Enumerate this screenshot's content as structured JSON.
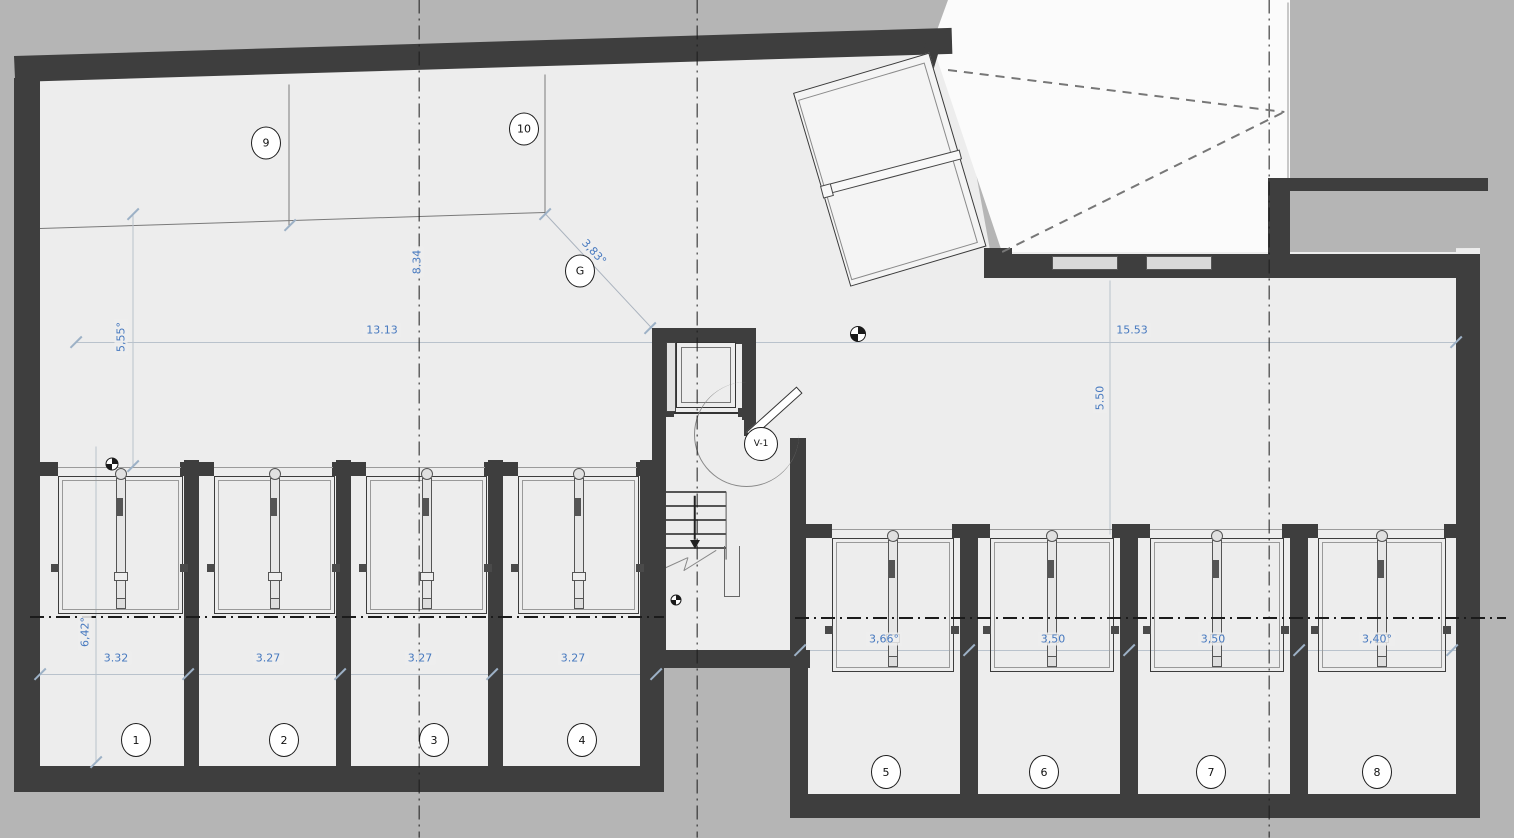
{
  "title": "basement-garage-floor-plan",
  "colors": {
    "background": "#b5b5b5",
    "floor": "#ededed",
    "wall": "#3e3e3e",
    "ramp_white": "#fbfbfb",
    "dim_blue": "#4779bf",
    "centerline": "#1b1b1b",
    "thin_line": "#7a7a7a",
    "dim_line": "#b9c2cc",
    "tick": "#9db1c6"
  },
  "watermark": {
    "part1": "DRAFT",
    "part2": "IИ",
    "part3": "HOMES"
  },
  "level_marker": {
    "value": "121,60"
  },
  "elevator": {
    "label": "Elevador"
  },
  "stairs": {
    "numbers_bottom_to_top": "-8 -9 -10 -11 -12 -13 -14 -15 -16"
  },
  "bubbles": [
    {
      "t": "9",
      "x": 266,
      "y": 143,
      "w": 28,
      "h": 31
    },
    {
      "t": "10",
      "x": 524,
      "y": 129,
      "w": 28,
      "h": 31
    },
    {
      "t": "G",
      "x": 580,
      "y": 271,
      "w": 28,
      "h": 31
    },
    {
      "t": "V-1",
      "x": 761,
      "y": 444,
      "w": 32,
      "h": 32,
      "fs": 9
    },
    {
      "t": "1",
      "x": 136,
      "y": 740,
      "w": 28,
      "h": 32
    },
    {
      "t": "2",
      "x": 284,
      "y": 740,
      "w": 28,
      "h": 32
    },
    {
      "t": "3",
      "x": 434,
      "y": 740,
      "w": 28,
      "h": 32
    },
    {
      "t": "4",
      "x": 582,
      "y": 740,
      "w": 28,
      "h": 32
    },
    {
      "t": "5",
      "x": 886,
      "y": 772,
      "w": 28,
      "h": 32
    },
    {
      "t": "6",
      "x": 1044,
      "y": 772,
      "w": 28,
      "h": 32
    },
    {
      "t": "7",
      "x": 1211,
      "y": 772,
      "w": 28,
      "h": 32
    },
    {
      "t": "8",
      "x": 1377,
      "y": 772,
      "w": 28,
      "h": 32
    }
  ],
  "dim_labels": [
    {
      "t": "13.13",
      "x": 382,
      "y": 330,
      "r": 0
    },
    {
      "t": "15.53",
      "x": 1132,
      "y": 330,
      "r": 0
    },
    {
      "t": "5,55°",
      "x": 121,
      "y": 337,
      "r": -90
    },
    {
      "t": "8.34",
      "x": 417,
      "y": 262,
      "r": -90
    },
    {
      "t": "5.50",
      "x": 1100,
      "y": 398,
      "r": -90
    },
    {
      "t": "6,42°",
      "x": 85,
      "y": 632,
      "r": -90
    },
    {
      "t": "3.32",
      "x": 116,
      "y": 658,
      "r": 0
    },
    {
      "t": "3.27",
      "x": 268,
      "y": 658,
      "r": 0
    },
    {
      "t": "3.27",
      "x": 420,
      "y": 658,
      "r": 0
    },
    {
      "t": "3.27",
      "x": 573,
      "y": 658,
      "r": 0
    },
    {
      "t": "3,66°",
      "x": 884,
      "y": 639,
      "r": 0
    },
    {
      "t": "3,50",
      "x": 1053,
      "y": 639,
      "r": 0
    },
    {
      "t": "3,50",
      "x": 1213,
      "y": 639,
      "r": 0
    },
    {
      "t": "3,40°",
      "x": 1377,
      "y": 639,
      "r": 0
    },
    {
      "t": "3,83°",
      "x": 594,
      "y": 252,
      "r": 47
    }
  ],
  "geometry": {
    "floors": [
      {
        "name": "floor-interior",
        "color": "#ededed",
        "points": "14,58 950,30 990,250 1480,248 1480,818 792,818 792,664 650,664 650,792 14,792"
      },
      {
        "name": "ramp-driveway",
        "color": "#fbfbfb",
        "points": "932,44 948,0 1290,0 1290,252 1002,252"
      },
      {
        "name": "outside-pocket",
        "color": "#b5b5b5",
        "points": "1290,190 1456,190 1456,252 1290,252"
      }
    ],
    "walls": [
      [
        14,
        56,
        938,
        26,
        -1.72
      ],
      [
        14,
        78,
        26,
        714,
        0
      ],
      [
        14,
        766,
        650,
        26,
        0
      ],
      [
        640,
        460,
        24,
        306,
        0
      ],
      [
        184,
        460,
        15,
        306,
        0
      ],
      [
        336,
        460,
        15,
        306,
        0
      ],
      [
        488,
        460,
        15,
        306,
        0
      ],
      [
        40,
        462,
        18,
        14,
        0
      ],
      [
        180,
        462,
        34,
        14,
        0
      ],
      [
        332,
        462,
        34,
        14,
        0
      ],
      [
        484,
        462,
        34,
        14,
        0
      ],
      [
        636,
        462,
        28,
        14,
        0
      ],
      [
        652,
        328,
        104,
        16,
        0
      ],
      [
        652,
        328,
        14,
        92,
        0
      ],
      [
        742,
        328,
        14,
        92,
        0
      ],
      [
        652,
        420,
        14,
        248,
        0
      ],
      [
        652,
        650,
        158,
        18,
        0
      ],
      [
        790,
        438,
        16,
        212,
        0
      ],
      [
        744,
        408,
        12,
        28,
        0
      ],
      [
        790,
        650,
        18,
        168,
        0
      ],
      [
        790,
        794,
        690,
        24,
        0
      ],
      [
        1456,
        260,
        24,
        558,
        0
      ],
      [
        988,
        254,
        492,
        24,
        0
      ],
      [
        1268,
        178,
        220,
        13,
        0
      ],
      [
        1268,
        183,
        22,
        76,
        0
      ],
      [
        926,
        42,
        15,
        216,
        16.5
      ],
      [
        984,
        248,
        28,
        30,
        0
      ],
      [
        960,
        524,
        18,
        270,
        0
      ],
      [
        1120,
        524,
        18,
        270,
        0
      ],
      [
        1290,
        524,
        18,
        270,
        0
      ],
      [
        790,
        524,
        42,
        14,
        0
      ],
      [
        952,
        524,
        38,
        14,
        0
      ],
      [
        1112,
        524,
        38,
        14,
        0
      ],
      [
        1282,
        524,
        36,
        14,
        0
      ],
      [
        1444,
        524,
        14,
        14,
        0
      ],
      [
        662,
        408,
        12,
        9,
        0
      ],
      [
        738,
        408,
        12,
        9,
        0
      ]
    ],
    "boxes": [
      {
        "n": "gate-leaf",
        "b": [
          793,
          93,
          140,
          200,
          -16.5
        ],
        "fill": "#f4f4f4",
        "bc": "#3a3a3a",
        "bw": 1.5
      },
      {
        "n": "gate-leaf-inner",
        "b": [
          798,
          100,
          130,
          186,
          -16.5
        ],
        "fill": "transparent",
        "bc": "#8a8a8a",
        "bw": 1
      },
      {
        "n": "gate-arm",
        "b": [
          828,
          184,
          134,
          8,
          -14.7
        ],
        "fill": "#f8f8f8",
        "bc": "#444",
        "bw": 1
      },
      {
        "n": "gate-arm-tip",
        "b": [
          820,
          186,
          9,
          11,
          -14.7
        ],
        "fill": "#f8f8f8",
        "bc": "#444",
        "bw": 1
      },
      {
        "n": "elevator-cab",
        "b": [
          676,
          342,
          58,
          64,
          0
        ],
        "fill": "#ededed",
        "bc": "#333",
        "bw": 1.5
      },
      {
        "n": "elevator-cab-inner",
        "b": [
          681,
          347,
          48,
          54,
          0
        ],
        "fill": "transparent",
        "bc": "#777",
        "bw": 1
      },
      {
        "n": "elevator-rail",
        "b": [
          666,
          342,
          8,
          68,
          0
        ],
        "fill": "#e0e0e0",
        "bc": "#444",
        "bw": 1
      },
      {
        "n": "wall-grille",
        "b": [
          1052,
          256,
          64,
          12,
          0
        ],
        "fill": "#d9d9d9",
        "bc": "#555",
        "bw": 1
      },
      {
        "n": "wall-grille",
        "b": [
          1146,
          256,
          64,
          12,
          0
        ],
        "fill": "#d9d9d9",
        "bc": "#555",
        "bw": 1
      },
      {
        "n": "door-v1-leaf",
        "b": [
          746,
          432,
          66,
          7,
          -42
        ],
        "fill": "#fff",
        "bc": "#333",
        "bw": 1.5
      },
      {
        "n": "door-v1-arc",
        "b": [
          694,
          382,
          104,
          104,
          0
        ],
        "fill": "transparent",
        "bc": "#888",
        "bw": 1.2,
        "radius": "50%",
        "sides": "lb"
      },
      {
        "n": "stair-handrail",
        "b": [
          724,
          546,
          14,
          50,
          0
        ],
        "fill": "transparent",
        "bc": "#666",
        "bw": 1.5,
        "sides": "lrb"
      }
    ],
    "lines": [
      [
        76,
        342,
        1458,
        342,
        1,
        "#b9c2cc"
      ],
      [
        40,
        228,
        545,
        212,
        1,
        "#7a7a7a"
      ],
      [
        289,
        84,
        289,
        226,
        1,
        "#7a7a7a"
      ],
      [
        545,
        74,
        545,
        213,
        1,
        "#7a7a7a"
      ],
      [
        545,
        213,
        654,
        330,
        1,
        "#aab3be"
      ],
      [
        1288,
        2,
        1288,
        184,
        1,
        "#949494"
      ],
      [
        133,
        214,
        133,
        466,
        1,
        "#b9c2cc"
      ],
      [
        96,
        446,
        96,
        762,
        1,
        "#b9c2cc"
      ],
      [
        1110,
        280,
        1110,
        534,
        1,
        "#b9c2cc"
      ],
      [
        40,
        674,
        658,
        674,
        1,
        "#b9c2cc"
      ],
      [
        800,
        650,
        1456,
        650,
        1,
        "#b9c2cc"
      ],
      [
        664,
        413,
        742,
        413,
        1.5,
        "#333"
      ],
      [
        666,
        492,
        726,
        492,
        1.2,
        "#555"
      ],
      [
        666,
        506,
        726,
        506,
        1.2,
        "#555"
      ],
      [
        666,
        520,
        726,
        520,
        1.2,
        "#555"
      ],
      [
        666,
        534,
        726,
        534,
        1.2,
        "#555"
      ],
      [
        666,
        548,
        726,
        548,
        1.2,
        "#555"
      ],
      [
        726,
        492,
        726,
        560,
        1.2,
        "#555"
      ],
      [
        695,
        496,
        695,
        540,
        1.5,
        "#222"
      ],
      [
        664,
        568,
        688,
        557,
        1,
        "#888"
      ],
      [
        688,
        557,
        684,
        570,
        1,
        "#888"
      ],
      [
        684,
        570,
        716,
        550,
        1,
        "#888"
      ]
    ],
    "dashdot": [
      [
        419,
        0,
        419,
        838
      ],
      [
        697,
        0,
        697,
        838
      ],
      [
        1269,
        0,
        1269,
        838
      ],
      [
        30,
        617,
        664,
        617
      ],
      [
        795,
        618,
        1506,
        618
      ]
    ],
    "dashed": [
      [
        948,
        70,
        1284,
        112
      ],
      [
        1002,
        252,
        1284,
        112
      ]
    ],
    "ticks": [
      [
        76,
        342
      ],
      [
        1456,
        342
      ],
      [
        133,
        214
      ],
      [
        133,
        466
      ],
      [
        96,
        762
      ],
      [
        40,
        674
      ],
      [
        188,
        674
      ],
      [
        340,
        674
      ],
      [
        492,
        674
      ],
      [
        656,
        674
      ],
      [
        800,
        650
      ],
      [
        969,
        650
      ],
      [
        1129,
        650
      ],
      [
        1299,
        650
      ],
      [
        1452,
        650
      ],
      [
        290,
        225
      ],
      [
        545,
        214
      ],
      [
        650,
        328
      ]
    ],
    "benchmarks": [
      [
        858,
        334,
        14
      ],
      [
        112,
        464,
        11
      ],
      [
        676,
        600,
        9
      ]
    ],
    "doors": {
      "left": {
        "y0": 476,
        "depth": 136,
        "frames": [
          [
            58,
            181
          ],
          [
            214,
            333
          ],
          [
            366,
            485
          ],
          [
            518,
            637
          ]
        ]
      },
      "right": {
        "y0": 538,
        "depth": 132,
        "frames": [
          [
            832,
            952
          ],
          [
            990,
            1112
          ],
          [
            1150,
            1282
          ],
          [
            1318,
            1444
          ]
        ]
      }
    }
  }
}
